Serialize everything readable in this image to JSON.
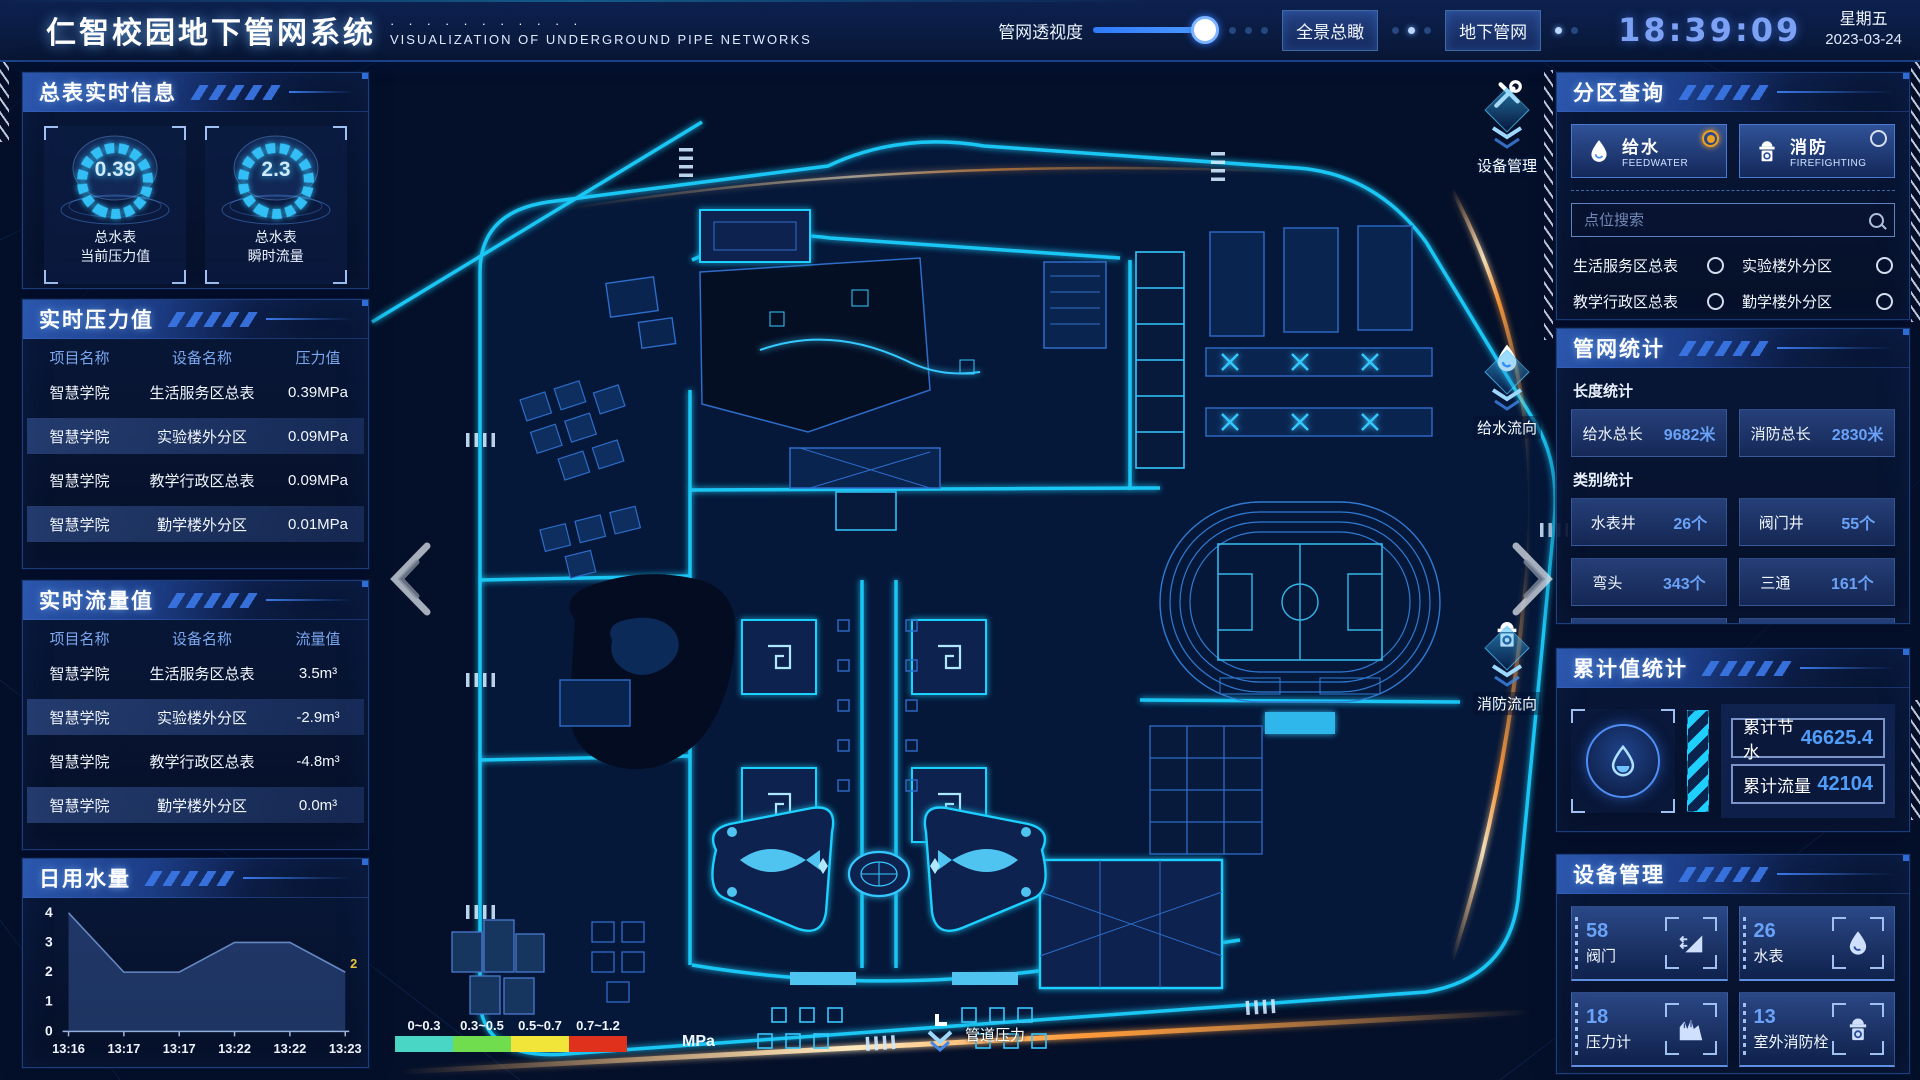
{
  "header": {
    "title": "仁智校园地下管网系统",
    "dots": "···········",
    "subtitle": "VISUALIZATION OF UNDERGROUND PIPE NETWORKS",
    "transparency_label": "管网透视度",
    "btn_overview": "全景总瞰",
    "btn_underground": "地下管网",
    "time": "18:39:09",
    "weekday": "星期五",
    "date": "2023-03-24"
  },
  "left": {
    "meter_panel": {
      "title": "总表实时信息",
      "gauges": [
        {
          "value": "0.39",
          "label1": "总水表",
          "label2": "当前压力值"
        },
        {
          "value": "2.3",
          "label1": "总水表",
          "label2": "瞬时流量"
        }
      ]
    },
    "pressure_panel": {
      "title": "实时压力值",
      "headers": [
        "项目名称",
        "设备名称",
        "压力值"
      ],
      "rows": [
        {
          "project": "智慧学院",
          "device": "生活服务区总表",
          "value": "0.39MPa"
        },
        {
          "project": "智慧学院",
          "device": "实验楼外分区",
          "value": "0.09MPa"
        },
        {
          "project": "智慧学院",
          "device": "教学行政区总表",
          "value": "0.09MPa"
        },
        {
          "project": "智慧学院",
          "device": "勤学楼外分区",
          "value": "0.01MPa"
        },
        {
          "project": "智慧学院",
          "device": "砺学楼外分区",
          "value": "0.00MPa"
        }
      ]
    },
    "flow_panel": {
      "title": "实时流量值",
      "headers": [
        "项目名称",
        "设备名称",
        "流量值"
      ],
      "rows": [
        {
          "project": "智慧学院",
          "device": "生活服务区总表",
          "value": "3.5m³"
        },
        {
          "project": "智慧学院",
          "device": "实验楼外分区",
          "value": "-2.9m³"
        },
        {
          "project": "智慧学院",
          "device": "教学行政区总表",
          "value": "-4.8m³"
        },
        {
          "project": "智慧学院",
          "device": "勤学楼外分区",
          "value": "0.0m³"
        },
        {
          "project": "智慧学院",
          "device": "砺学楼外分区",
          "value": "2.3m³"
        }
      ]
    },
    "daily_panel": {
      "title": "日用水量"
    }
  },
  "chart_data": {
    "type": "area",
    "title": "日用水量",
    "x": [
      "13:16",
      "13:17",
      "13:17",
      "13:22",
      "13:22",
      "13:23"
    ],
    "values": [
      4,
      2,
      2,
      3,
      3,
      2
    ],
    "ylim": [
      0,
      4
    ],
    "yticks": [
      0,
      1,
      2,
      3,
      4
    ],
    "end_label": "2",
    "legend_position": "none",
    "grid": false
  },
  "right": {
    "zone_panel": {
      "title": "分区查询",
      "feedwater": {
        "label": "给水",
        "sub": "FEEDWATER"
      },
      "firefighting": {
        "label": "消防",
        "sub": "FIREFIGHTING"
      },
      "search_placeholder": "点位搜索",
      "items": [
        "生活服务区总表",
        "实验楼外分区",
        "教学行政区总表",
        "勤学楼外分区",
        "砺学楼外分区",
        "宿舍区泵房"
      ]
    },
    "stats_panel": {
      "title": "管网统计",
      "length_label": "长度统计",
      "length_stats": [
        {
          "label": "给水总长",
          "value": "9682米"
        },
        {
          "label": "消防总长",
          "value": "2830米"
        }
      ],
      "category_label": "类别统计",
      "category_stats": [
        {
          "label": "水表井",
          "value": "26个"
        },
        {
          "label": "阀门井",
          "value": "55个"
        },
        {
          "label": "弯头",
          "value": "343个"
        },
        {
          "label": "三通",
          "value": "161个"
        }
      ]
    },
    "cumulative_panel": {
      "title": "累计值统计",
      "rows": [
        {
          "label": "累计节水",
          "value": "46625.4"
        },
        {
          "label": "累计流量",
          "value": "42104"
        }
      ]
    },
    "device_panel": {
      "title": "设备管理",
      "cards": [
        {
          "count": "58",
          "unit": "个",
          "label": "阀门",
          "icon": "valve-icon"
        },
        {
          "count": "26",
          "unit": "套",
          "label": "水表",
          "icon": "water-meter-icon"
        },
        {
          "count": "18",
          "unit": "个",
          "label": "压力计",
          "icon": "pressure-gauge-icon"
        },
        {
          "count": "13",
          "unit": "套",
          "label": "室外消防栓",
          "icon": "hydrant-icon"
        }
      ]
    }
  },
  "map": {
    "tools": [
      {
        "label": "设备管理",
        "icon": "wrench-icon"
      },
      {
        "label": "给水流向",
        "icon": "water-drop-icon"
      },
      {
        "label": "消防流向",
        "icon": "hydrant-icon"
      }
    ],
    "legend": {
      "ranges": [
        "0~0.3",
        "0.3~0.5",
        "0.5~0.7",
        "0.7~1.2"
      ],
      "colors": [
        "#49d6c5",
        "#6fdd4e",
        "#f2e53a",
        "#e0311d"
      ],
      "unit": "MPa",
      "pipe_label": "管道压力"
    },
    "accent_colors": {
      "road_glow": "#1fd0ff",
      "building_stroke": "#2e6cc8",
      "warm_glow": "#ffb05a"
    }
  }
}
